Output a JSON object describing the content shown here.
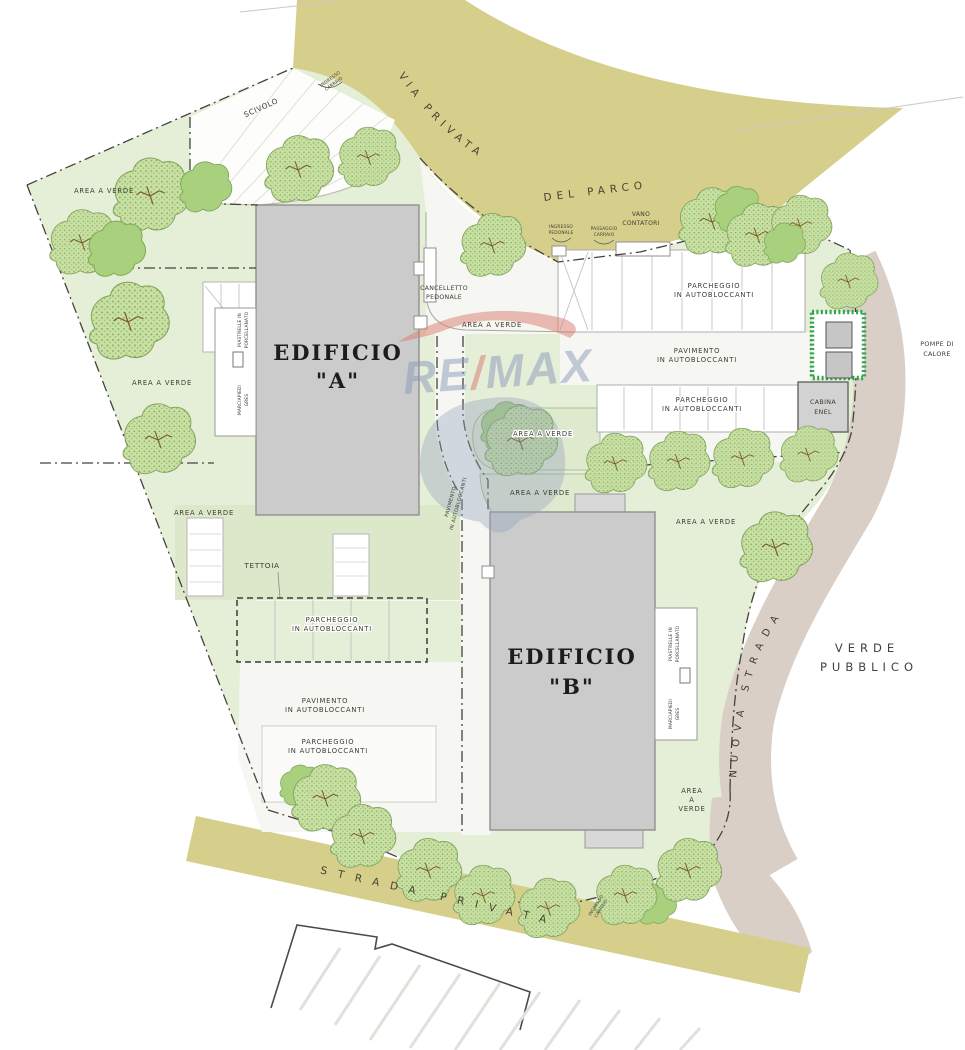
{
  "plan": {
    "roads": {
      "via_privata": "VIA PRIVATA",
      "del_parco": "DEL PARCO",
      "nuova_strada": "NUOVA STRADA",
      "strada_privata": "STRADA PRIVATA",
      "verde_pubblico_line1": "VERDE",
      "verde_pubblico_line2": "PUBBLICO"
    },
    "buildings": {
      "edificio": "EDIFICIO",
      "a_quote": "\"A\"",
      "b_quote": "\"B\""
    },
    "labels": {
      "area_a_verde": "AREA A VERDE",
      "area_word": "AREA",
      "a_word": "A",
      "verde_word": "VERDE",
      "scivolo": "SCIVOLO",
      "vano": "VANO",
      "contatori": "CONTATORI",
      "ingresso": "INGRESSO",
      "pedonale": "PEDONALE",
      "passaggio": "PASSAGGIO",
      "carraio": "CARRAIO",
      "cancelletto": "CANCELLETTO",
      "parcheggio": "PARCHEGGIO",
      "in_autobloccanti": "IN AUTOBLOCCANTI",
      "pavimento": "PAVIMENTO",
      "tettoia": "TETTOIA",
      "cabina": "CABINA",
      "enel": "ENEL",
      "pompe_line1": "POMPE DI",
      "pompe_line2": "CALORE",
      "marciapiedi": "MARCIAPIEDI",
      "gres": "GRES",
      "piastrelle": "PIASTRELLE IN",
      "porcellanato": "PORCELLANATO"
    },
    "watermark": {
      "re": "RE",
      "slash": "/",
      "max": "MAX"
    },
    "colors": {
      "road_yellow": "#d6cf8b",
      "road_taupe": "#d9cfc6",
      "site_green": "#e5eed7",
      "pocket_green": "#dfe9cd",
      "tree_green": "#c8e0a2",
      "building_gray": "#cbcbcb",
      "hedge_green": "#2fa44c",
      "paved_white": "#f6f7f2"
    }
  }
}
